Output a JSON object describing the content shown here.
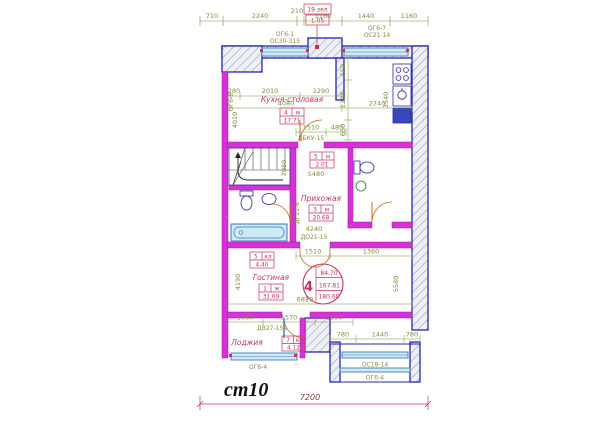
{
  "note": {
    "mark": "ст10"
  },
  "flag": {
    "top": "19 зел",
    "bottom": "1.05"
  },
  "rooms": {
    "kitchen": {
      "label": "Кухня-столовая",
      "num": "4",
      "unit": "м",
      "area": "17.71"
    },
    "hall": {
      "label": "Прихожая",
      "num": "3",
      "unit": "м",
      "area": "20.68"
    },
    "living": {
      "label": "Гостиная",
      "num": "1",
      "unit": "ж",
      "area": "31.69"
    },
    "loggia": {
      "label": "Лоджия",
      "num": "7",
      "unit": "кл",
      "area": "4.12"
    },
    "wc": {
      "num": "5",
      "unit": "м",
      "area": "2.01"
    },
    "closet": {
      "num": "5",
      "unit": "кл",
      "area": "4.40"
    }
  },
  "stamp": {
    "number": "4",
    "line1": "84.70",
    "line2": "167.81",
    "line3": "180.60",
    "floor": "1"
  },
  "windows": {
    "top_left_a": "ОГ6-1",
    "top_left_b": "ОС30-315",
    "top_right_a": "ОГ6-7",
    "top_right_b": "ОС21-14",
    "left_side": "ОГ6-8",
    "loggia": "ОГ6-4",
    "porch_a": "ОС18-14",
    "porch_b": "ОГ6-4"
  },
  "doors": {
    "kitchen_hall": "ДБКУ-15",
    "entrance": "ДО21-15",
    "loggia": "ДВ27-15а",
    "bath": "ДГ21-8"
  },
  "dims": {
    "top": [
      "710",
      "2240",
      "210",
      "1160",
      "1440",
      "1160"
    ],
    "kitchen_top": [
      "280",
      "2010",
      "1290"
    ],
    "kitchen_span": [
      "4080",
      "2740"
    ],
    "niche": [
      "650",
      "1205",
      "650"
    ],
    "kitchen_right_v": "3540",
    "left_v": "4010",
    "mid": [
      "1510",
      "480"
    ],
    "hall_w": "5480",
    "stairs_v": "2080",
    "entr": "4240",
    "living_top": [
      "1510",
      "1360"
    ],
    "living_span": "6820",
    "living_left_v": "4190",
    "living_right_v": "5580",
    "loggia_row": [
      "1080",
      "1570",
      "1160"
    ],
    "porch_row": [
      "780",
      "1440",
      "780"
    ],
    "total": "7200"
  },
  "colors": {
    "wall_blue": "#2626a8",
    "partition_magenta": "#d633d6",
    "dimension_green": "#7a923c",
    "annotation_red": "#c23360",
    "window_cyan": "#cfe9f5",
    "door_orange": "#cc6a1f",
    "mark_black": "#111111"
  }
}
